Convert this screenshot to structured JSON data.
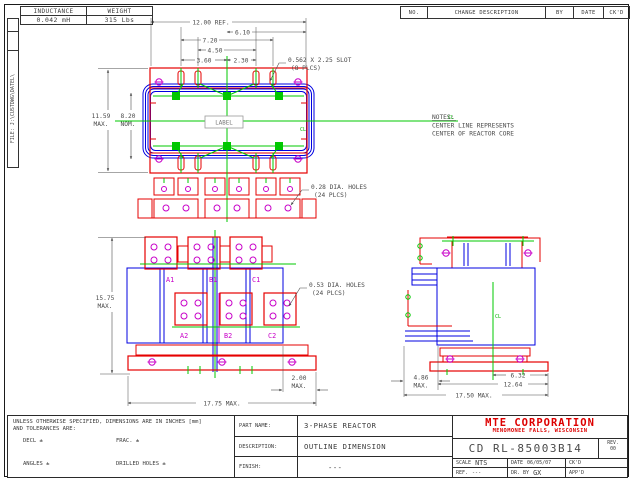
{
  "frame": {
    "file_label": "FILE: J:\\CUSTDWG\\DATEL\\"
  },
  "spec_table": {
    "inductance_header": "INDUCTANCE",
    "weight_header": "WEIGHT",
    "inductance_value": "0.042 mH",
    "weight_value": "315 Lbs"
  },
  "revision_table": {
    "no": "NO.",
    "change_description": "CHANGE DESCRIPTION",
    "by": "BY",
    "date": "DATE",
    "ckd": "CK'D"
  },
  "notes": {
    "title": "NOTES:",
    "line1": "CENTER LINE REPRESENTS",
    "line2": "CENTER OF REACTOR CORE"
  },
  "top_view": {
    "label_text": "LABEL",
    "dim_12": "12.00 REF.",
    "dim_610": "6.10",
    "dim_720": "7.20",
    "dim_450": "4.50",
    "dim_360": "3.60",
    "dim_230": "2.30",
    "dim_1159_l1": "11.59",
    "dim_1159_l2": "MAX.",
    "dim_820_l1": "8.20",
    "dim_820_l2": "NOM.",
    "slot_callout_l1": "0.562 X 2.25 SLOT",
    "slot_callout_l2": "(8 PLCS)",
    "hole_callout_l1": "0.28 DIA. HOLES",
    "hole_callout_l2": "(24 PLCS)",
    "cl": "CL"
  },
  "front_view": {
    "terminals_top": [
      "A1",
      "B1",
      "C1"
    ],
    "terminals_bottom": [
      "A2",
      "B2",
      "C2"
    ],
    "dim_1575_l1": "15.75",
    "dim_1575_l2": "MAX.",
    "dim_1775": "17.75 MAX.",
    "dim_200_l1": "2.00",
    "dim_200_l2": "MAX.",
    "hole_callout_l1": "0.53 DIA. HOLES",
    "hole_callout_l2": "(24 PLCS)"
  },
  "side_view": {
    "dim_486_l1": "4.86",
    "dim_486_l2": "MAX.",
    "dim_1264": "12.64",
    "dim_632": "6.32",
    "dim_1750": "17.50 MAX.",
    "cl": "CL"
  },
  "title_block": {
    "tolerance_line1": "UNLESS OTHERWISE SPECIFIED, DIMENSIONS ARE IN INCHES [mm]",
    "tolerance_line2": "AND TOLERANCES ARE:",
    "dec": "DECL ±",
    "frac": "FRAC. ±",
    "angles": "ANGLES ±",
    "drilled": "DRILLED HOLES ±",
    "part_name_label": "PART NAME:",
    "part_name": "3-PHASE REACTOR",
    "description_label": "DESCRIPTION:",
    "description": "OUTLINE DIMENSION",
    "finish_label": "FINISH:",
    "finish": "---",
    "company_name": "MTE CORPORATION",
    "company_city": "MENOMONEE FALLS, WISCONSIN",
    "drawing_number": "CD RL-85003B14",
    "rev_label": "REV.",
    "rev_value": "00",
    "scale_label": "SCALE",
    "scale_value": "NTS",
    "date_label": "DATE",
    "date_value": "06/05/07",
    "ckd_label": "CK'D",
    "ref_label": "REF.",
    "ref_value": "---",
    "drby_label": "DR. BY",
    "drby_value": "GX",
    "appd_label": "APP'D"
  },
  "colors": {
    "core_red": "#e60000",
    "coil_blue": "#0000e0",
    "centerline_green": "#00c800",
    "terminal_magenta": "#c800c8",
    "dimension_gray": "#4d4d4d",
    "company_red": "#dd0000"
  }
}
